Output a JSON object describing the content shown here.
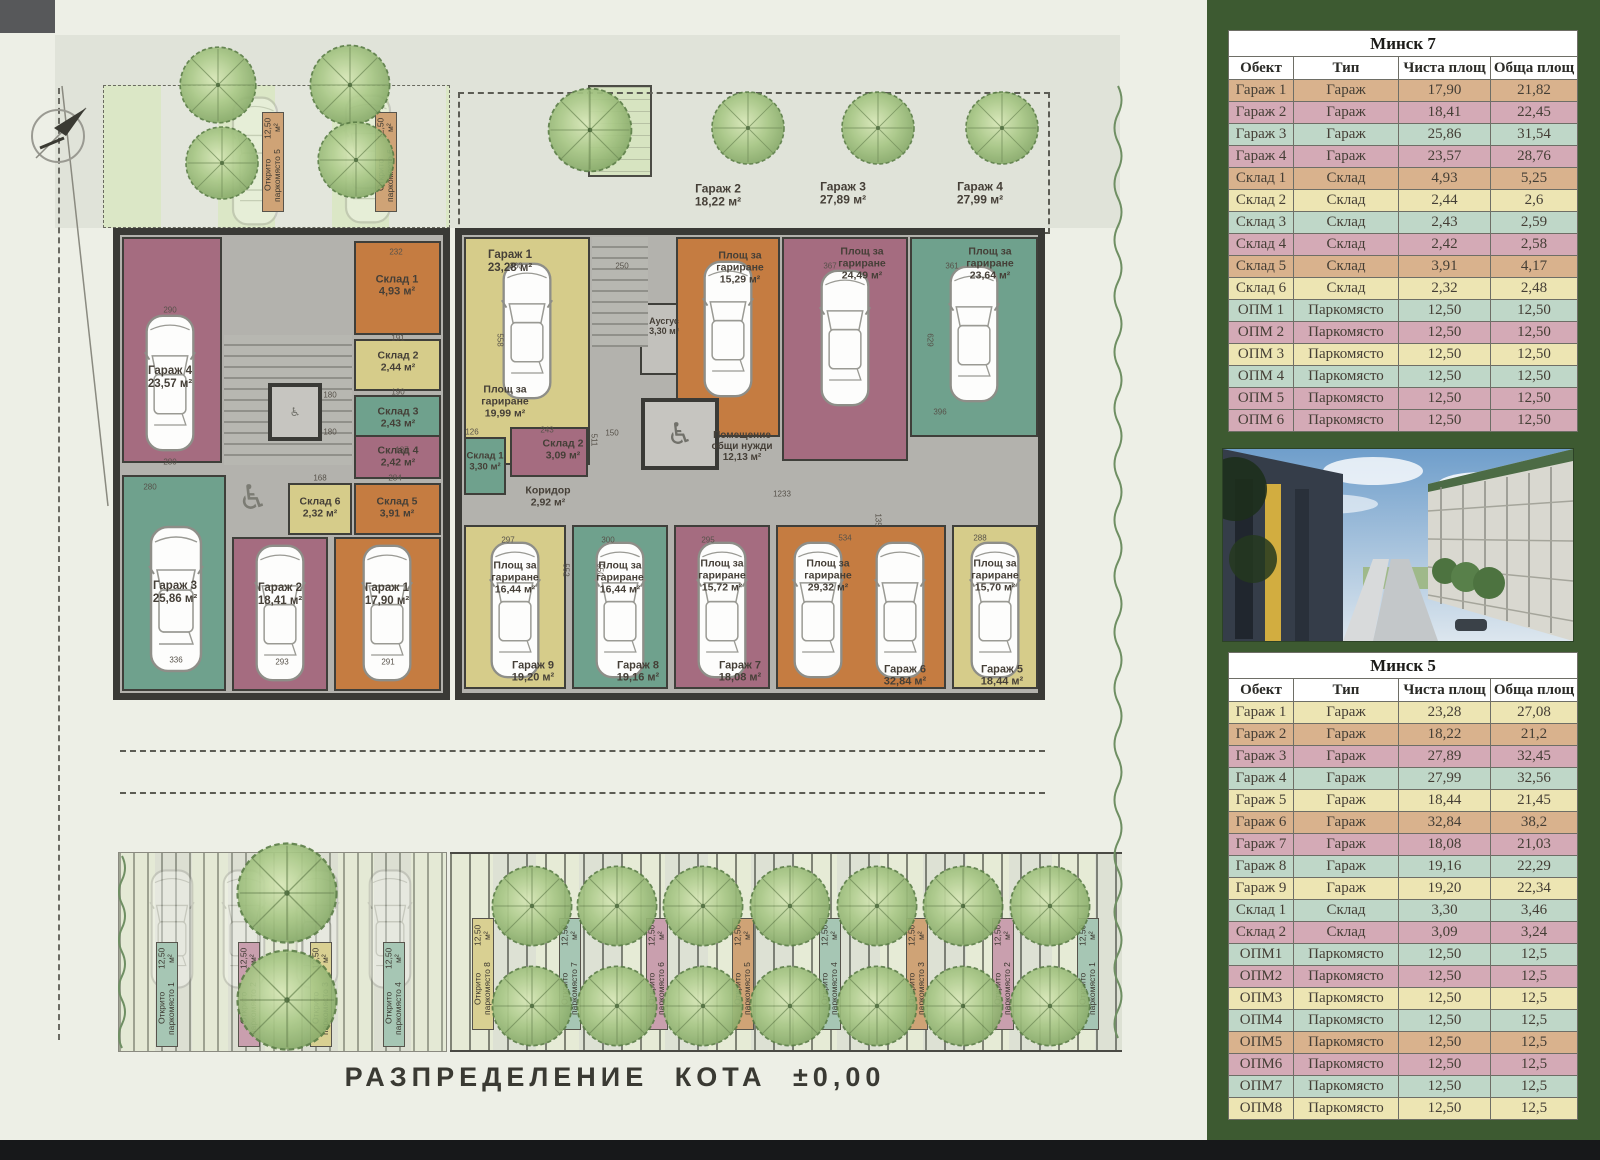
{
  "colors": {
    "tan": "#d9b28d",
    "pink": "#d4aab6",
    "teal": "#bfd7c8",
    "yellow": "#ede5b3"
  },
  "tables": [
    {
      "title": "Минск 7",
      "headers": [
        "Обект",
        "Тип",
        "Чиста площ",
        "Обща площ"
      ],
      "rows": [
        {
          "c": "tan",
          "cells": [
            "Гараж 1",
            "Гараж",
            "17,90",
            "21,82"
          ]
        },
        {
          "c": "pink",
          "cells": [
            "Гараж 2",
            "Гараж",
            "18,41",
            "22,45"
          ]
        },
        {
          "c": "teal",
          "cells": [
            "Гараж 3",
            "Гараж",
            "25,86",
            "31,54"
          ]
        },
        {
          "c": "pink",
          "cells": [
            "Гараж 4",
            "Гараж",
            "23,57",
            "28,76"
          ]
        },
        {
          "c": "tan",
          "cells": [
            "Склад 1",
            "Склад",
            "4,93",
            "5,25"
          ]
        },
        {
          "c": "yellow",
          "cells": [
            "Склад 2",
            "Склад",
            "2,44",
            "2,6"
          ]
        },
        {
          "c": "teal",
          "cells": [
            "Склад 3",
            "Склад",
            "2,43",
            "2,59"
          ]
        },
        {
          "c": "pink",
          "cells": [
            "Склад 4",
            "Склад",
            "2,42",
            "2,58"
          ]
        },
        {
          "c": "tan",
          "cells": [
            "Склад 5",
            "Склад",
            "3,91",
            "4,17"
          ]
        },
        {
          "c": "yellow",
          "cells": [
            "Склад 6",
            "Склад",
            "2,32",
            "2,48"
          ]
        },
        {
          "c": "teal",
          "cells": [
            "ОПМ 1",
            "Паркомясто",
            "12,50",
            "12,50"
          ]
        },
        {
          "c": "pink",
          "cells": [
            "ОПМ 2",
            "Паркомясто",
            "12,50",
            "12,50"
          ]
        },
        {
          "c": "yellow",
          "cells": [
            "ОПМ 3",
            "Паркомясто",
            "12,50",
            "12,50"
          ]
        },
        {
          "c": "teal",
          "cells": [
            "ОПМ 4",
            "Паркомясто",
            "12,50",
            "12,50"
          ]
        },
        {
          "c": "pink",
          "cells": [
            "ОПМ 5",
            "Паркомясто",
            "12,50",
            "12,50"
          ]
        },
        {
          "c": "pink",
          "cells": [
            "ОПМ 6",
            "Паркомясто",
            "12,50",
            "12,50"
          ]
        }
      ]
    },
    {
      "title": "Минск 5",
      "headers": [
        "Обект",
        "Тип",
        "Чиста площ",
        "Обща площ"
      ],
      "rows": [
        {
          "c": "yellow",
          "cells": [
            "Гараж 1",
            "Гараж",
            "23,28",
            "27,08"
          ]
        },
        {
          "c": "tan",
          "cells": [
            "Гараж 2",
            "Гараж",
            "18,22",
            "21,2"
          ]
        },
        {
          "c": "pink",
          "cells": [
            "Гараж 3",
            "Гараж",
            "27,89",
            "32,45"
          ]
        },
        {
          "c": "teal",
          "cells": [
            "Гараж 4",
            "Гараж",
            "27,99",
            "32,56"
          ]
        },
        {
          "c": "yellow",
          "cells": [
            "Гараж 5",
            "Гараж",
            "18,44",
            "21,45"
          ]
        },
        {
          "c": "tan",
          "cells": [
            "Гараж 6",
            "Гараж",
            "32,84",
            "38,2"
          ]
        },
        {
          "c": "pink",
          "cells": [
            "Гараж 7",
            "Гараж",
            "18,08",
            "21,03"
          ]
        },
        {
          "c": "teal",
          "cells": [
            "Гараж 8",
            "Гараж",
            "19,16",
            "22,29"
          ]
        },
        {
          "c": "yellow",
          "cells": [
            "Гараж 9",
            "Гараж",
            "19,20",
            "22,34"
          ]
        },
        {
          "c": "teal",
          "cells": [
            "Склад 1",
            "Склад",
            "3,30",
            "3,46"
          ]
        },
        {
          "c": "pink",
          "cells": [
            "Склад 2",
            "Склад",
            "3,09",
            "3,24"
          ]
        },
        {
          "c": "teal",
          "cells": [
            "ОПМ1",
            "Паркомясто",
            "12,50",
            "12,5"
          ]
        },
        {
          "c": "pink",
          "cells": [
            "ОПМ2",
            "Паркомясто",
            "12,50",
            "12,5"
          ]
        },
        {
          "c": "yellow",
          "cells": [
            "ОПМ3",
            "Паркомясто",
            "12,50",
            "12,5"
          ]
        },
        {
          "c": "teal",
          "cells": [
            "ОПМ4",
            "Паркомясто",
            "12,50",
            "12,5"
          ]
        },
        {
          "c": "tan",
          "cells": [
            "ОПМ5",
            "Паркомясто",
            "12,50",
            "12,5"
          ]
        },
        {
          "c": "pink",
          "cells": [
            "ОПМ6",
            "Паркомясто",
            "12,50",
            "12,5"
          ]
        },
        {
          "c": "teal",
          "cells": [
            "ОПМ7",
            "Паркомясто",
            "12,50",
            "12,5"
          ]
        },
        {
          "c": "yellow",
          "cells": [
            "ОПМ8",
            "Паркомясто",
            "12,50",
            "12,5"
          ]
        }
      ]
    }
  ],
  "plan": {
    "title": "РАЗПРЕДЕЛЕНИЕ КОТА ±0,00",
    "m7": {
      "g1": {
        "name": "Гараж 1",
        "area": "17,90 м²"
      },
      "g2": {
        "name": "Гараж 2",
        "area": "18,41 м²"
      },
      "g3": {
        "name": "Гараж 3",
        "area": "25,86 м²"
      },
      "g4": {
        "name": "Гараж 4",
        "area": "23,57 м²"
      },
      "s1": {
        "name": "Склад 1",
        "area": "4,93 м²"
      },
      "s2": {
        "name": "Склад 2",
        "area": "2,44 м²"
      },
      "s3": {
        "name": "Склад 3",
        "area": "2,43 м²"
      },
      "s4": {
        "name": "Склад 4",
        "area": "2,42 м²"
      },
      "s5": {
        "name": "Склад 5",
        "area": "3,91 м²"
      },
      "s6": {
        "name": "Склад 6",
        "area": "2,32 м²"
      }
    },
    "m5": {
      "g1": {
        "name": "Гараж 1",
        "area": "23,28 м²"
      },
      "pa": {
        "name": "Площ за гариране",
        "area": "19,99 м²"
      },
      "pb": {
        "name": "Площ за гариране",
        "area": "15,29 м²"
      },
      "pc": {
        "name": "Площ за гариране",
        "area": "24,49 м²"
      },
      "pd": {
        "name": "Площ за гариране",
        "area": "23,64 м²"
      },
      "aus": {
        "name": "Аусгус",
        "area": "3,30 м²"
      },
      "s1": {
        "name": "Склад 1",
        "area": "3,30 м²"
      },
      "s2": {
        "name": "Склад 2",
        "area": "3,09 м²"
      },
      "kor": {
        "name": "Коридор",
        "area": "2,92 м²"
      },
      "obsh": {
        "name": "Помещение общи нужди",
        "area": "12,13 м²"
      },
      "g9a": {
        "name": "Площ за гариране",
        "area": "16,44 м²"
      },
      "g9": {
        "name": "Гараж 9",
        "area": "19,20 м²"
      },
      "g8a": {
        "name": "Площ за гариране",
        "area": "16,44 м²"
      },
      "g8": {
        "name": "Гараж 8",
        "area": "19,16 м²"
      },
      "g7a": {
        "name": "Площ за гариране",
        "area": "15,72 м²"
      },
      "g7": {
        "name": "Гараж 7",
        "area": "18,08 м²"
      },
      "g6a": {
        "name": "Площ за гариране",
        "area": "29,32 м²"
      },
      "g6": {
        "name": "Гараж 6",
        "area": "32,84 м²"
      },
      "g5a": {
        "name": "Площ за гариране",
        "area": "15,70 м²"
      },
      "g5": {
        "name": "Гараж 5",
        "area": "18,44 м²"
      },
      "d2": {
        "name": "Гараж 2",
        "area": "18,22 м²"
      },
      "d3": {
        "name": "Гараж 3",
        "area": "27,89 м²"
      },
      "d4": {
        "name": "Гараж 4",
        "area": "27,99 м²"
      }
    },
    "stalls_m7": [
      {
        "name": "Открито паркомясто 1",
        "area": "12,50 м²"
      },
      {
        "name": "Открито паркомясто 2",
        "area": "12,50 м²"
      },
      {
        "name": "Открито паркомясто 3",
        "area": "12,50 м²"
      },
      {
        "name": "Открито паркомясто 4",
        "area": "12,50 м²"
      },
      {
        "name": "Открито паркомясто 5",
        "area": "12,50 м²"
      },
      {
        "name": "Открито паркомясто 6",
        "area": "12,50 м²"
      }
    ],
    "stalls_m5": [
      {
        "name": "Открито паркомясто 1",
        "area": "12,50 м²"
      },
      {
        "name": "Открито паркомясто 2",
        "area": "12,50 м²"
      },
      {
        "name": "Открито паркомясто 3",
        "area": "12,50 м²"
      },
      {
        "name": "Открито паркомясто 4",
        "area": "12,50 м²"
      },
      {
        "name": "Открито паркомясто 5",
        "area": "12,50 м²"
      },
      {
        "name": "Открито паркомясто 6",
        "area": "12,50 м²"
      },
      {
        "name": "Открито паркомясто 7",
        "area": "12,50 м²"
      },
      {
        "name": "Открито паркомясто 8",
        "area": "12,50 м²"
      }
    ],
    "dimensions": [
      {
        "t": "290",
        "x": 170,
        "y": 310
      },
      {
        "t": "280",
        "x": 170,
        "y": 462
      },
      {
        "t": "280",
        "x": 150,
        "y": 487
      },
      {
        "t": "336",
        "x": 176,
        "y": 660
      },
      {
        "t": "293",
        "x": 282,
        "y": 662
      },
      {
        "t": "291",
        "x": 388,
        "y": 662
      },
      {
        "t": "232",
        "x": 396,
        "y": 252
      },
      {
        "t": "191",
        "x": 398,
        "y": 338
      },
      {
        "t": "190",
        "x": 398,
        "y": 392
      },
      {
        "t": "180",
        "x": 330,
        "y": 395
      },
      {
        "t": "180",
        "x": 330,
        "y": 432
      },
      {
        "t": "187",
        "x": 402,
        "y": 450
      },
      {
        "t": "168",
        "x": 320,
        "y": 478
      },
      {
        "t": "284",
        "x": 395,
        "y": 478
      },
      {
        "t": "126",
        "x": 472,
        "y": 432
      },
      {
        "t": "243",
        "x": 547,
        "y": 430
      },
      {
        "t": "150",
        "x": 612,
        "y": 433
      },
      {
        "t": "250",
        "x": 622,
        "y": 266
      },
      {
        "t": "360",
        "x": 516,
        "y": 266
      },
      {
        "t": "367",
        "x": 830,
        "y": 266
      },
      {
        "t": "361",
        "x": 952,
        "y": 266
      },
      {
        "t": "297",
        "x": 508,
        "y": 540
      },
      {
        "t": "300",
        "x": 608,
        "y": 540
      },
      {
        "t": "295",
        "x": 708,
        "y": 540
      },
      {
        "t": "534",
        "x": 845,
        "y": 538
      },
      {
        "t": "288",
        "x": 980,
        "y": 538
      },
      {
        "t": "1233",
        "x": 782,
        "y": 494
      },
      {
        "t": "396",
        "x": 940,
        "y": 412
      },
      {
        "t": "558",
        "x": 500,
        "y": 340,
        "r": 1
      },
      {
        "t": "550",
        "x": 600,
        "y": 570,
        "r": 1
      },
      {
        "t": "629",
        "x": 930,
        "y": 340,
        "r": 1
      },
      {
        "t": "552",
        "x": 566,
        "y": 570,
        "r": 1
      },
      {
        "t": "511",
        "x": 594,
        "y": 440,
        "r": 1
      },
      {
        "t": "135",
        "x": 878,
        "y": 520,
        "r": 1
      }
    ]
  }
}
